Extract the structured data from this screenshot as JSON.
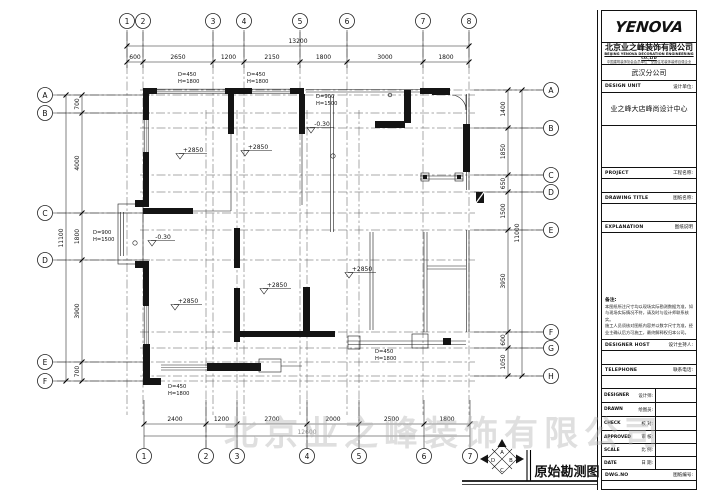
{
  "sheet": {
    "drawing_title": "原始勘测图",
    "watermark": "北京业之峰装饰有限公司"
  },
  "compass": {
    "top": "A",
    "right": "B",
    "bottom": "C",
    "left": "D"
  },
  "grid": {
    "top": [
      "1",
      "2",
      "3",
      "4",
      "5",
      "6",
      "7",
      "8"
    ],
    "bottom": [
      "1",
      "2",
      "3",
      "4",
      "5",
      "6",
      "7"
    ],
    "left": [
      "A",
      "B",
      "C",
      "D",
      "E",
      "F"
    ],
    "right": [
      "A",
      "B",
      "C",
      "D",
      "E",
      "F",
      "G",
      "H"
    ]
  },
  "dims": {
    "top_total": "13200",
    "top": [
      "600",
      "2650",
      "1200",
      "2150",
      "1800",
      "3000",
      "1800"
    ],
    "bottom_total": "12600",
    "bottom": [
      "2400",
      "1200",
      "2700",
      "2000",
      "2500",
      "1800"
    ],
    "left_total": "11100",
    "left": [
      "700",
      "4000",
      "1800",
      "3900",
      "700"
    ],
    "right_total": "11000",
    "right": [
      "1400",
      "1850",
      "650",
      "1500",
      "3950",
      "600",
      "1050"
    ]
  },
  "labels": {
    "levels": [
      "+2850",
      "+2850",
      "+2850",
      "+2850",
      "+2850"
    ],
    "floor": [
      "-0.30",
      "-0.30"
    ],
    "win450": "D=450",
    "win450h": "H=1800",
    "win900": "D=900",
    "win900h": "H=1500"
  },
  "title_block": {
    "logo": "YENOVA",
    "company_cn": "北京业之峰装饰有限公司",
    "company_en": "BEIJING YENOVA DECORATION ENGINEERING CO.,LTD",
    "company_sub": "中国建筑装饰协会会员单位 · 全国住宅装饰装修百强企业",
    "branch": "武汉分公司",
    "fields": {
      "design_unit": {
        "en": "DESIGN UNIT",
        "cn": "设计单位:",
        "value": "业之峰大店峰尚设计中心"
      },
      "project": {
        "en": "PROJECT",
        "cn": "工程名称:"
      },
      "drawing_title": {
        "en": "DRAWING TITLE",
        "cn": "图纸名称:"
      },
      "explanation": {
        "en": "EXPLANATION",
        "cn": "图纸说明"
      },
      "designer_host": {
        "en": "DESIGNER HOST",
        "cn": "设计主持人:"
      },
      "telephone": {
        "en": "TELEPHONE",
        "cn": "联系电话:"
      },
      "dwg_no": {
        "en": "DWG.NO",
        "cn": "图纸编号:"
      }
    },
    "note_title": "备注:",
    "note_lines": [
      "本图纸所注尺寸均以现场实际勘测数据为准，如",
      "与现场实际情况不符，请及时与设计师联系核实。",
      "施工人员须核对图纸内容并以数字尺寸为准，经",
      "业主确认后方可施工，最终解释权归本公司。"
    ],
    "rows": [
      {
        "en": "DESIGNER",
        "cn": "设计师:"
      },
      {
        "en": "DRAWN",
        "cn": "绘图员:"
      },
      {
        "en": "CHECK",
        "cn": "校  对:"
      },
      {
        "en": "APPROVED",
        "cn": "审  核:"
      },
      {
        "en": "SCALE",
        "cn": "比  例:"
      },
      {
        "en": "DATE",
        "cn": "日  期:"
      }
    ]
  }
}
